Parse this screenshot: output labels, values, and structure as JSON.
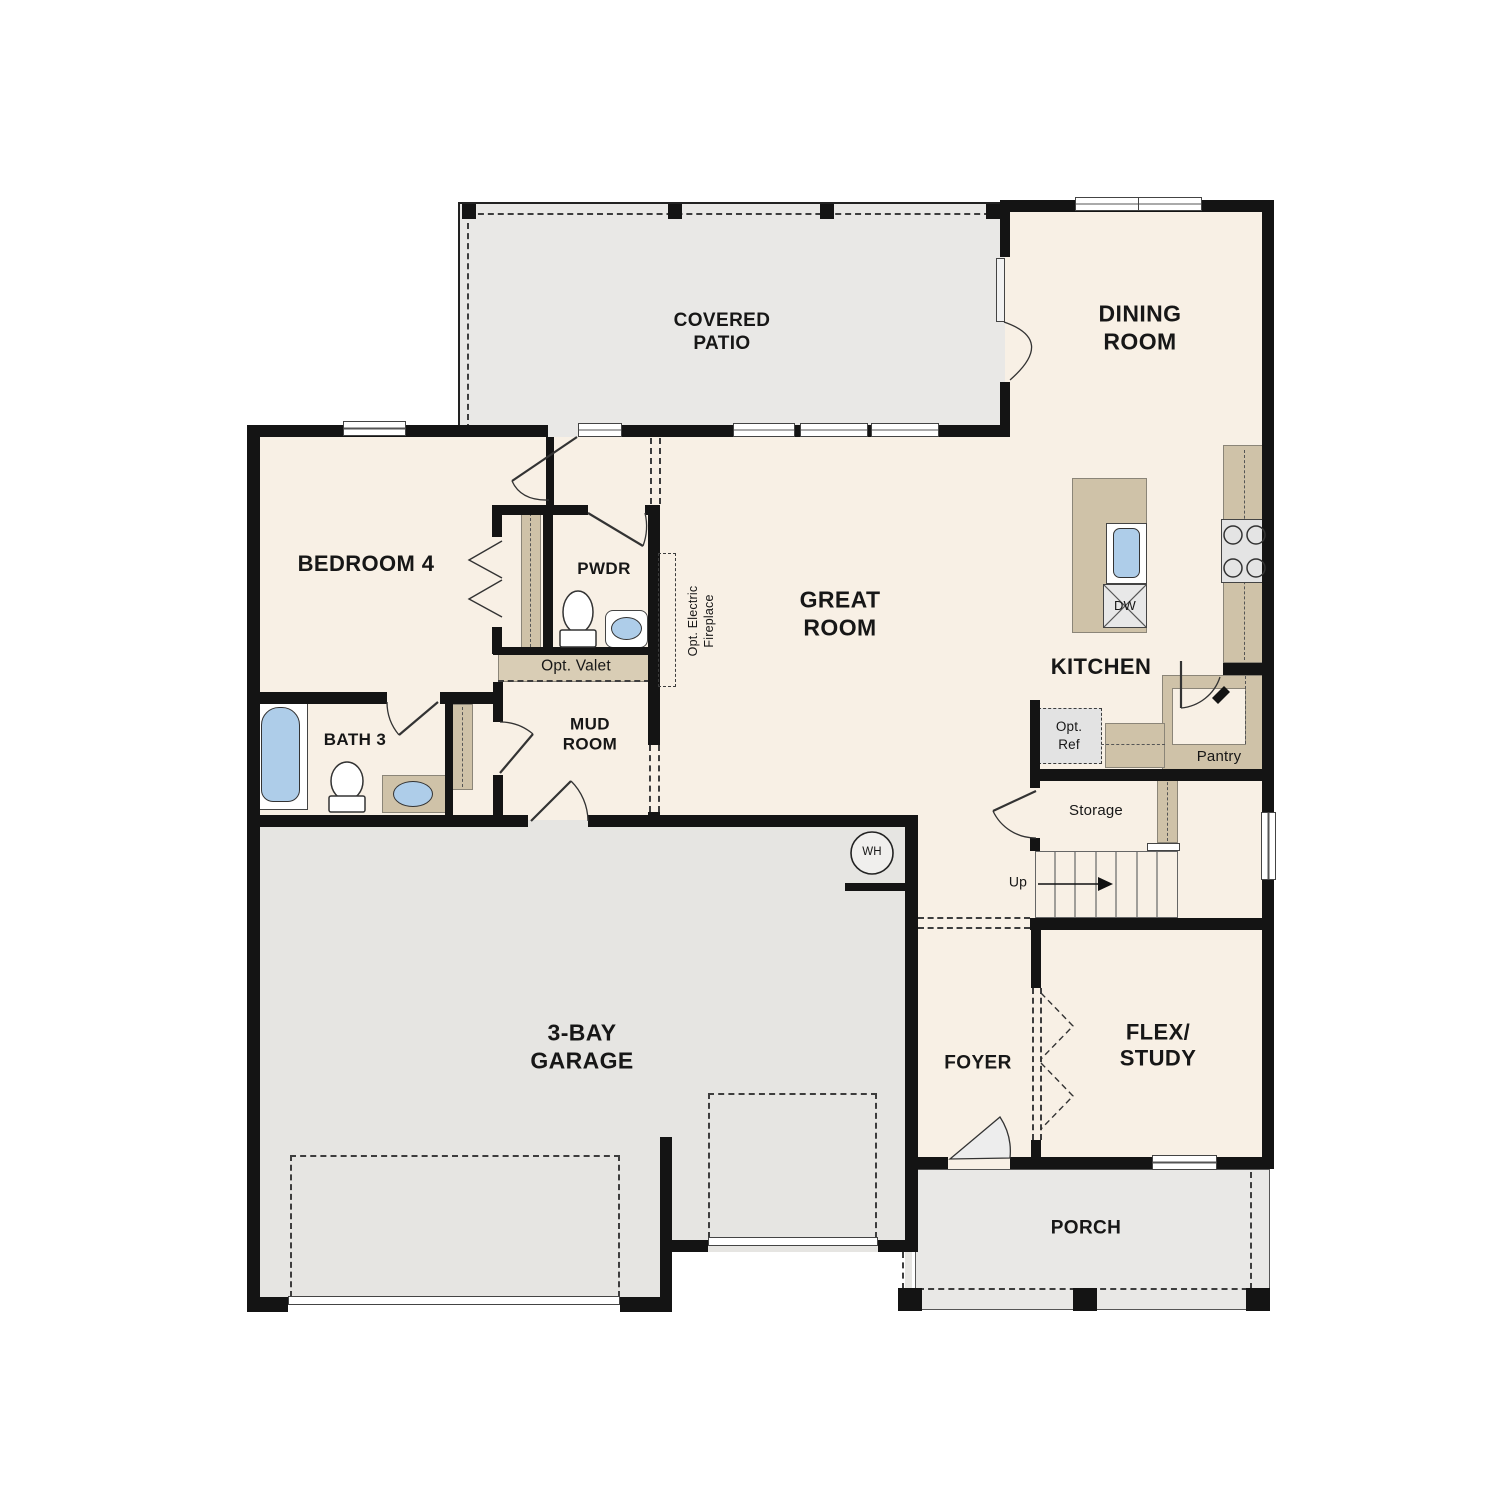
{
  "plan": {
    "type": "single-story residential floor plan",
    "rooms": {
      "covered_patio": {
        "line1": "COVERED",
        "line2": "PATIO"
      },
      "dining_room": {
        "line1": "DINING",
        "line2": "ROOM"
      },
      "great_room": {
        "line1": "GREAT",
        "line2": "ROOM"
      },
      "bedroom_4": {
        "label": "BEDROOM 4"
      },
      "powder": {
        "label": "PWDR"
      },
      "kitchen": {
        "label": "KITCHEN"
      },
      "mud_room": {
        "line1": "MUD",
        "line2": "ROOM"
      },
      "bath_3": {
        "label": "BATH 3"
      },
      "garage": {
        "line1": "3-BAY",
        "line2": "GARAGE"
      },
      "foyer": {
        "label": "FOYER"
      },
      "flex_study": {
        "line1": "FLEX/",
        "line2": "STUDY"
      },
      "porch": {
        "label": "PORCH"
      }
    },
    "annotations": {
      "opt_valet": "Opt. Valet",
      "pantry": "Pantry",
      "storage": "Storage",
      "up": "Up",
      "opt_ref_line1": "Opt.",
      "opt_ref_line2": "Ref",
      "dishwasher": "DW",
      "water_heater": "WH",
      "opt_fireplace_line1": "Opt. Electric",
      "opt_fireplace_line2": "Fireplace"
    },
    "colors": {
      "wall": "#141414",
      "interior_floor": "#f8f0e5",
      "patio_floor": "#e9e8e6",
      "garage_floor": "#e6e5e2",
      "porch_floor": "#e9e8e6",
      "cabinetry": "#cfc2a8",
      "cabinetry_light": "#d9cdb5",
      "fixture_blue": "#aecde9"
    }
  }
}
